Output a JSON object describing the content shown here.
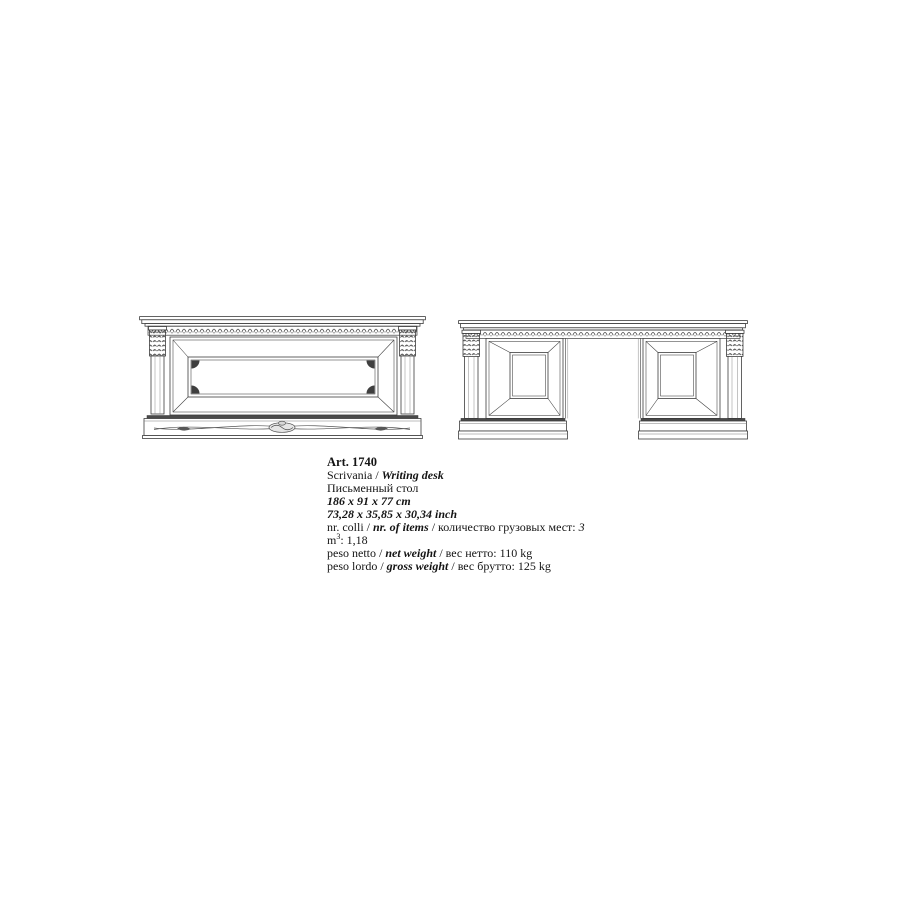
{
  "colors": {
    "background": "#ffffff",
    "ink": "#141414",
    "line_art": "#3d3d3d"
  },
  "figures": {
    "back_view": "desk back view line drawing",
    "front_view": "desk front view line drawing"
  },
  "spec": {
    "article": "Art. 1740",
    "title_it": "Scrivania / ",
    "title_en": "Writing desk",
    "title_ru": "Письменный стол",
    "size_cm": "186 x 91 x 77 cm",
    "size_inch": "73,28 x 35,85 x 30,34 inch",
    "packing": {
      "label_it": "nr. colli / ",
      "label_en": "nr. of items",
      "label_ru": " / количество грузовых мест: ",
      "value": "3"
    },
    "volume": {
      "unit": "m",
      "sup": "3",
      "value": ": 1,18"
    },
    "net": {
      "label_it": "peso netto / ",
      "label_en": "net weight",
      "label_ru": " / вес нетто: ",
      "value": "110 kg"
    },
    "gross": {
      "label_it": "peso lordo / ",
      "label_en": "gross weight",
      "label_ru": " / вес брутто: ",
      "value": "125 kg"
    }
  }
}
